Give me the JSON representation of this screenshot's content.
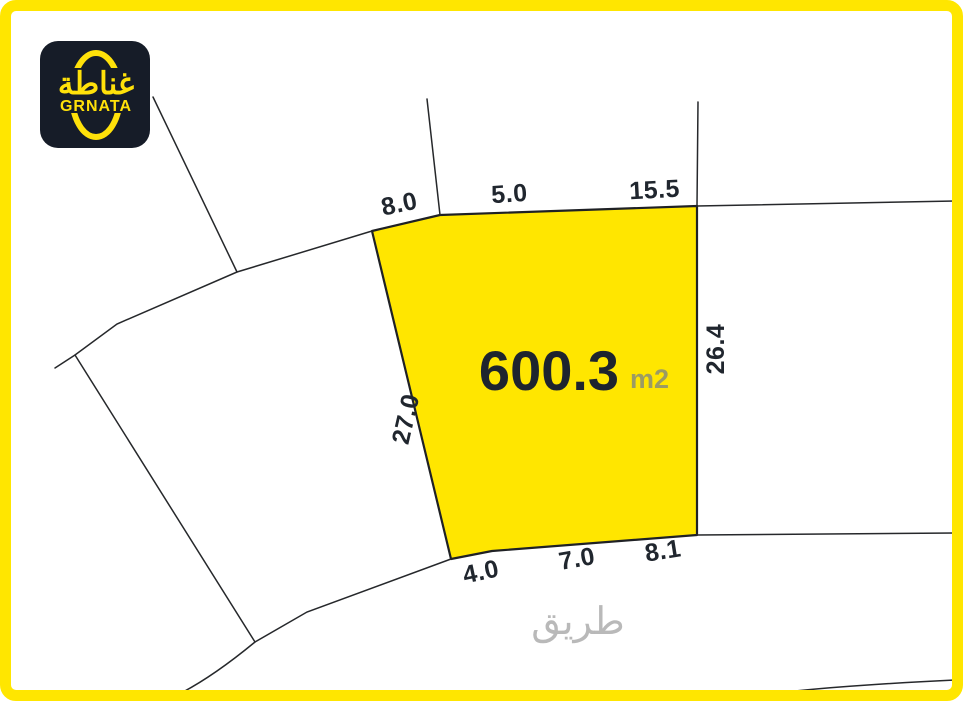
{
  "logo": {
    "arabic": "غناطة",
    "latin": "GRNATA"
  },
  "plot": {
    "area": {
      "value": "600.3",
      "unit": "m2"
    },
    "dimensions": {
      "top_1": "8.0",
      "top_2": "5.0",
      "top_3": "15.5",
      "right": "26.4",
      "left": "27.0",
      "bottom_1": "4.0",
      "bottom_2": "7.0",
      "bottom_3": "8.1"
    }
  },
  "road": {
    "label": "طريق"
  },
  "colors": {
    "accent_yellow": "#FFE600",
    "logo_background": "#161C28",
    "logo_yellow": "#FFE10A",
    "boundary_line": "#26282B",
    "dimension_text": "#20262E",
    "area_unit_text": "#9B9B64",
    "road_text": "#B9B9B9"
  }
}
